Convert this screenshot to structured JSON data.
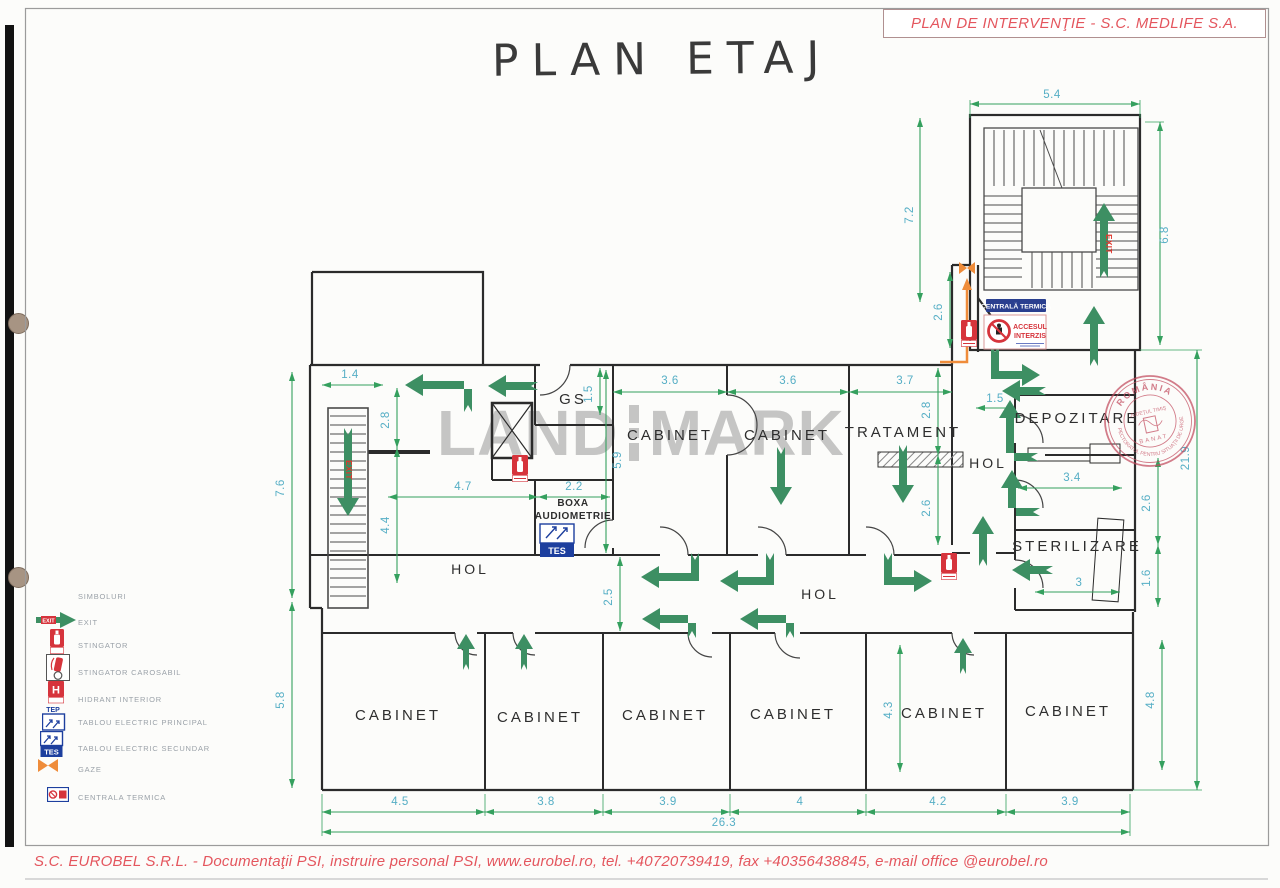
{
  "header": {
    "plan_label": "PLAN DE INTERVENŢIE - S.C. MEDLIFE S.A."
  },
  "title": "PLAN ETAJ",
  "watermark": {
    "part1": "LAND",
    "part2": "MARK"
  },
  "rooms": {
    "gs": "GS",
    "cabinets_top": [
      "CABINET",
      "CABINET"
    ],
    "tratament": "TRATAMENT",
    "boxa_line1": "BOXA",
    "boxa_line2": "AUDIOMETRIE",
    "hol_left": "HOL",
    "hol_main": "HOL",
    "hol_right": "HOL",
    "depozitare": "DEPOZITARE",
    "sterilizare": "STERILIZARE",
    "cabinets_bottom": [
      "CABINET",
      "CABINET",
      "CABINET",
      "CABINET",
      "CABINET",
      "CABINET"
    ]
  },
  "signs": {
    "exit": "EXIT",
    "centrala_termica": "CENTRALĂ TERMICĂ",
    "accesul_line1": "ACCESUL",
    "accesul_line2": "INTERZIS",
    "tes": "TES",
    "tep": "TEP",
    "hydrant_letter": "H"
  },
  "dims": [
    "5.4",
    "7.2",
    "6.8",
    "2.6",
    "1.4",
    "2.8",
    "1.5",
    "3.6",
    "3.6",
    "3.7",
    "2.8",
    "2.6",
    "1.5",
    "5.9",
    "2.2",
    "4.7",
    "7.6",
    "4.4",
    "3.4",
    "2.6",
    "2.5",
    "1.6",
    "3",
    "5.8",
    "4.3",
    "4.8",
    "4.5",
    "3.8",
    "3.9",
    "4",
    "4.2",
    "3.9",
    "26.3",
    "21.9"
  ],
  "legend": {
    "title": "SIMBOLURI",
    "items": [
      "EXIT",
      "STINGATOR",
      "STINGATOR CAROSABIL",
      "HIDRANT INTERIOR",
      "TABLOU ELECTRIC PRINCIPAL",
      "TABLOU ELECTRIC SECUNDAR",
      "GAZE",
      "CENTRALA TERMICA"
    ]
  },
  "stamp": {
    "country": "ROMÂNIA",
    "org": "INSPECTORATUL PENTRU SITUAŢII DE URGENŢĂ",
    "region": "JUDEŢUL TIMIŞ",
    "name": "BANAT"
  },
  "footer": {
    "text": "S.C. EUROBEL S.R.L. - Documentaţii PSI, instruire personal PSI, www.eurobel.ro, tel. +40720739419, fax +40356438845, e-mail office @eurobel.ro"
  }
}
